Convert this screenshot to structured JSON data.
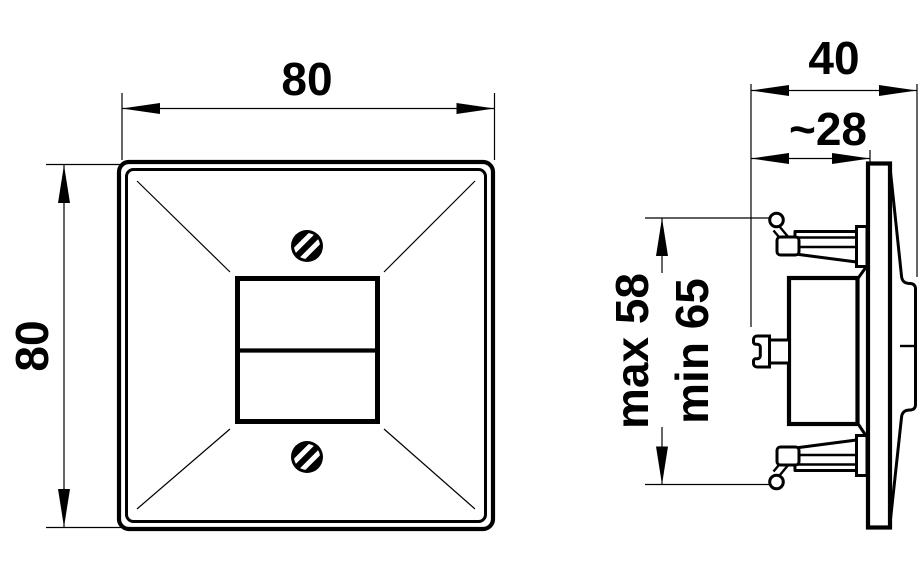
{
  "drawing": {
    "background_color": "#ffffff",
    "line_color": "#000000",
    "front_view": {
      "description": "front view of square cover plate with two screws and twin central apertures",
      "width_dim": "80",
      "height_dim": "80"
    },
    "side_view": {
      "description": "side section of flush-mount insert with expansion claws and wedge face plate",
      "overall_depth_dim": "40",
      "recess_depth_dim": "~28",
      "claw_span_dim_line1": "max 58",
      "claw_span_dim_line2": "min 65"
    }
  }
}
